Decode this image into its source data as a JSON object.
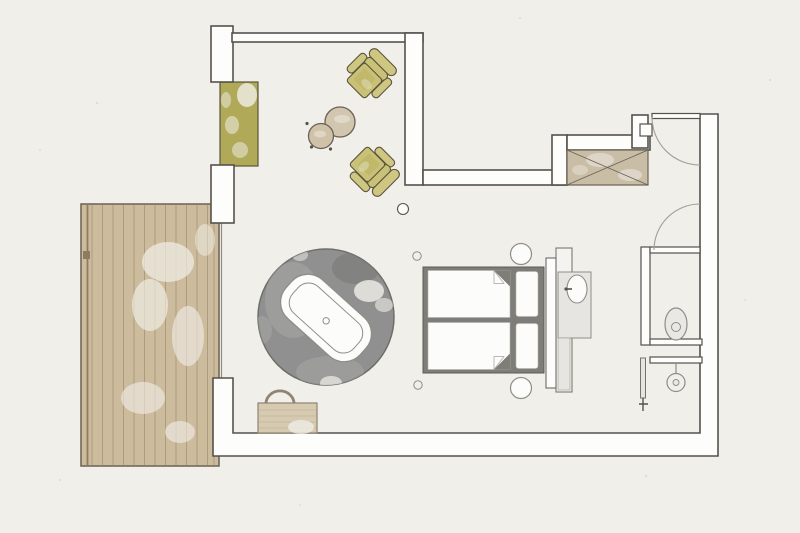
{
  "image": {
    "type": "architectural-floor-plan",
    "subject": "Hotel suite plan: terrace deck, lounge seating, round rug with freestanding bathtub, double bed with headboard vanity, wardrobe, entry door, toilet niche and walk-in shower",
    "visible_text": []
  },
  "palette": {
    "paper": "#f1efe9",
    "wall-fill": "#fdfdfc",
    "wall-line": "#55524c",
    "door-arc": "#a09e97",
    "soft-line": "#8f8d86",
    "glass-line": "#76736c",
    "deck-fill": "#ccbc9d",
    "deck-line": "#a2906f",
    "deck-edge": "#6b6154",
    "deck-accent": "#8d7c60",
    "olive-panel": "#b0a958",
    "khaki-seat": "#c9c178",
    "khaki-back": "#cfc781",
    "khaki-dark": "#b9b05e",
    "khaki-line": "#5a553c",
    "tan-fill": "#c9bda6",
    "tan-line": "#6a6258",
    "table-fill": "#d2c6af",
    "table-small-fill": "#cfc2a9",
    "rug-fill": "#909090",
    "rug-line": "#6e6e6a",
    "rug-light": "#a7a7a5",
    "rug-dark": "#7c7c7a",
    "bedframe-fill": "#7f7d78",
    "bedframe-line": "#5d5b55",
    "white-fill": "#fcfcfa",
    "panel-fill": "#f4f3ef",
    "vanity-fill": "#e6e5e1",
    "fixture-fill": "#e9e8e4",
    "basket-fill": "#d6cab1",
    "basket-line": "#8f8474",
    "basket-stripe": "#c3b59a",
    "ink": "#55534e"
  },
  "items": [
    {
      "name": "terrace-deck",
      "kind": "wooden plank terrace, left side"
    },
    {
      "name": "sliding-glass-wall",
      "kind": "glazed opening between room and terrace"
    },
    {
      "name": "olive-window-panel",
      "kind": "olive glazing/planter panel in left wall"
    },
    {
      "name": "lounge-chair-1",
      "kind": "khaki armchair facing side tables"
    },
    {
      "name": "lounge-chair-2",
      "kind": "khaki armchair facing side tables"
    },
    {
      "name": "side-tables",
      "kind": "two round nesting side tables"
    },
    {
      "name": "wardrobe-bench",
      "kind": "crossed-box wardrobe/luggage bench at top wall"
    },
    {
      "name": "entry-door",
      "kind": "entrance door with swing arc, top right"
    },
    {
      "name": "bathroom-door",
      "kind": "inner door with swing arc to bath zone"
    },
    {
      "name": "round-rug",
      "kind": "round dark grey rug"
    },
    {
      "name": "freestanding-bathtub",
      "kind": "oval freestanding tub on rug, rotated"
    },
    {
      "name": "double-bed",
      "kind": "double bed, two mattresses with folded duvet corners and pillows"
    },
    {
      "name": "headboard",
      "kind": "headboard board behind bed"
    },
    {
      "name": "vanity-basin",
      "kind": "washbasin console behind headboard"
    },
    {
      "name": "bedside-stools",
      "kind": "two round stools at bed corners"
    },
    {
      "name": "laundry-basket",
      "kind": "basket with handle near bottom wall"
    },
    {
      "name": "toilet",
      "kind": "WC in niche, right side"
    },
    {
      "name": "walk-in-shower",
      "kind": "shower with glass screen and floor rose"
    },
    {
      "name": "floor-lamp",
      "kind": "small round floor lamp near seating"
    }
  ]
}
